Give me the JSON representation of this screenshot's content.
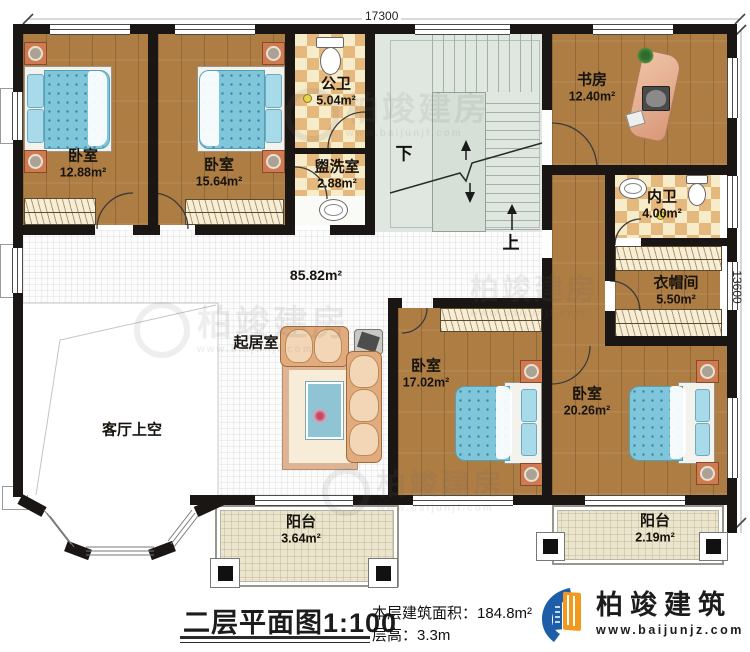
{
  "dimensions": {
    "width": "17300",
    "height": "13600"
  },
  "rooms": {
    "bedroom1": {
      "name": "卧室",
      "area": "12.88m²"
    },
    "bedroom2": {
      "name": "卧室",
      "area": "15.64m²"
    },
    "public_bath": {
      "name": "公卫",
      "area": "5.04m²"
    },
    "washroom": {
      "name": "盥洗室",
      "area": "2.88m²"
    },
    "study": {
      "name": "书房",
      "area": "12.40m²"
    },
    "private_bath": {
      "name": "内卫",
      "area": "4.00m²"
    },
    "cloakroom": {
      "name": "衣帽间",
      "area": "5.50m²"
    },
    "living": {
      "name": "起居室",
      "area": "85.82m²"
    },
    "void": {
      "name": "客厅上空"
    },
    "bedroom3": {
      "name": "卧室",
      "area": "17.02m²"
    },
    "bedroom4": {
      "name": "卧室",
      "area": "20.26m²"
    },
    "balcony1": {
      "name": "阳台",
      "area": "3.64m²"
    },
    "balcony2": {
      "name": "阳台",
      "area": "2.19m²"
    }
  },
  "stairs": {
    "down": "下",
    "up": "上"
  },
  "title_block": {
    "title": "二层平面图1:100",
    "floor_area_label": "本层建筑面积：",
    "floor_area_value": "184.8m²",
    "floor_height_label": "层高：",
    "floor_height_value": "3.3m"
  },
  "logo": {
    "name": "柏竣建筑",
    "url": "www.baijunjz.com"
  },
  "watermark": {
    "brand": "柏竣建房",
    "url": "www.baijunjf.com"
  },
  "colors": {
    "wall": "#1a1613",
    "wood": "#ad7d44",
    "tile_light": "#f6ecca",
    "tile_dark": "#e5b97e",
    "stair": "#e0e7e0",
    "balcony": "#ebe5cd",
    "brand_blue": "#1c5fa8",
    "brand_orange": "#f2991d"
  }
}
